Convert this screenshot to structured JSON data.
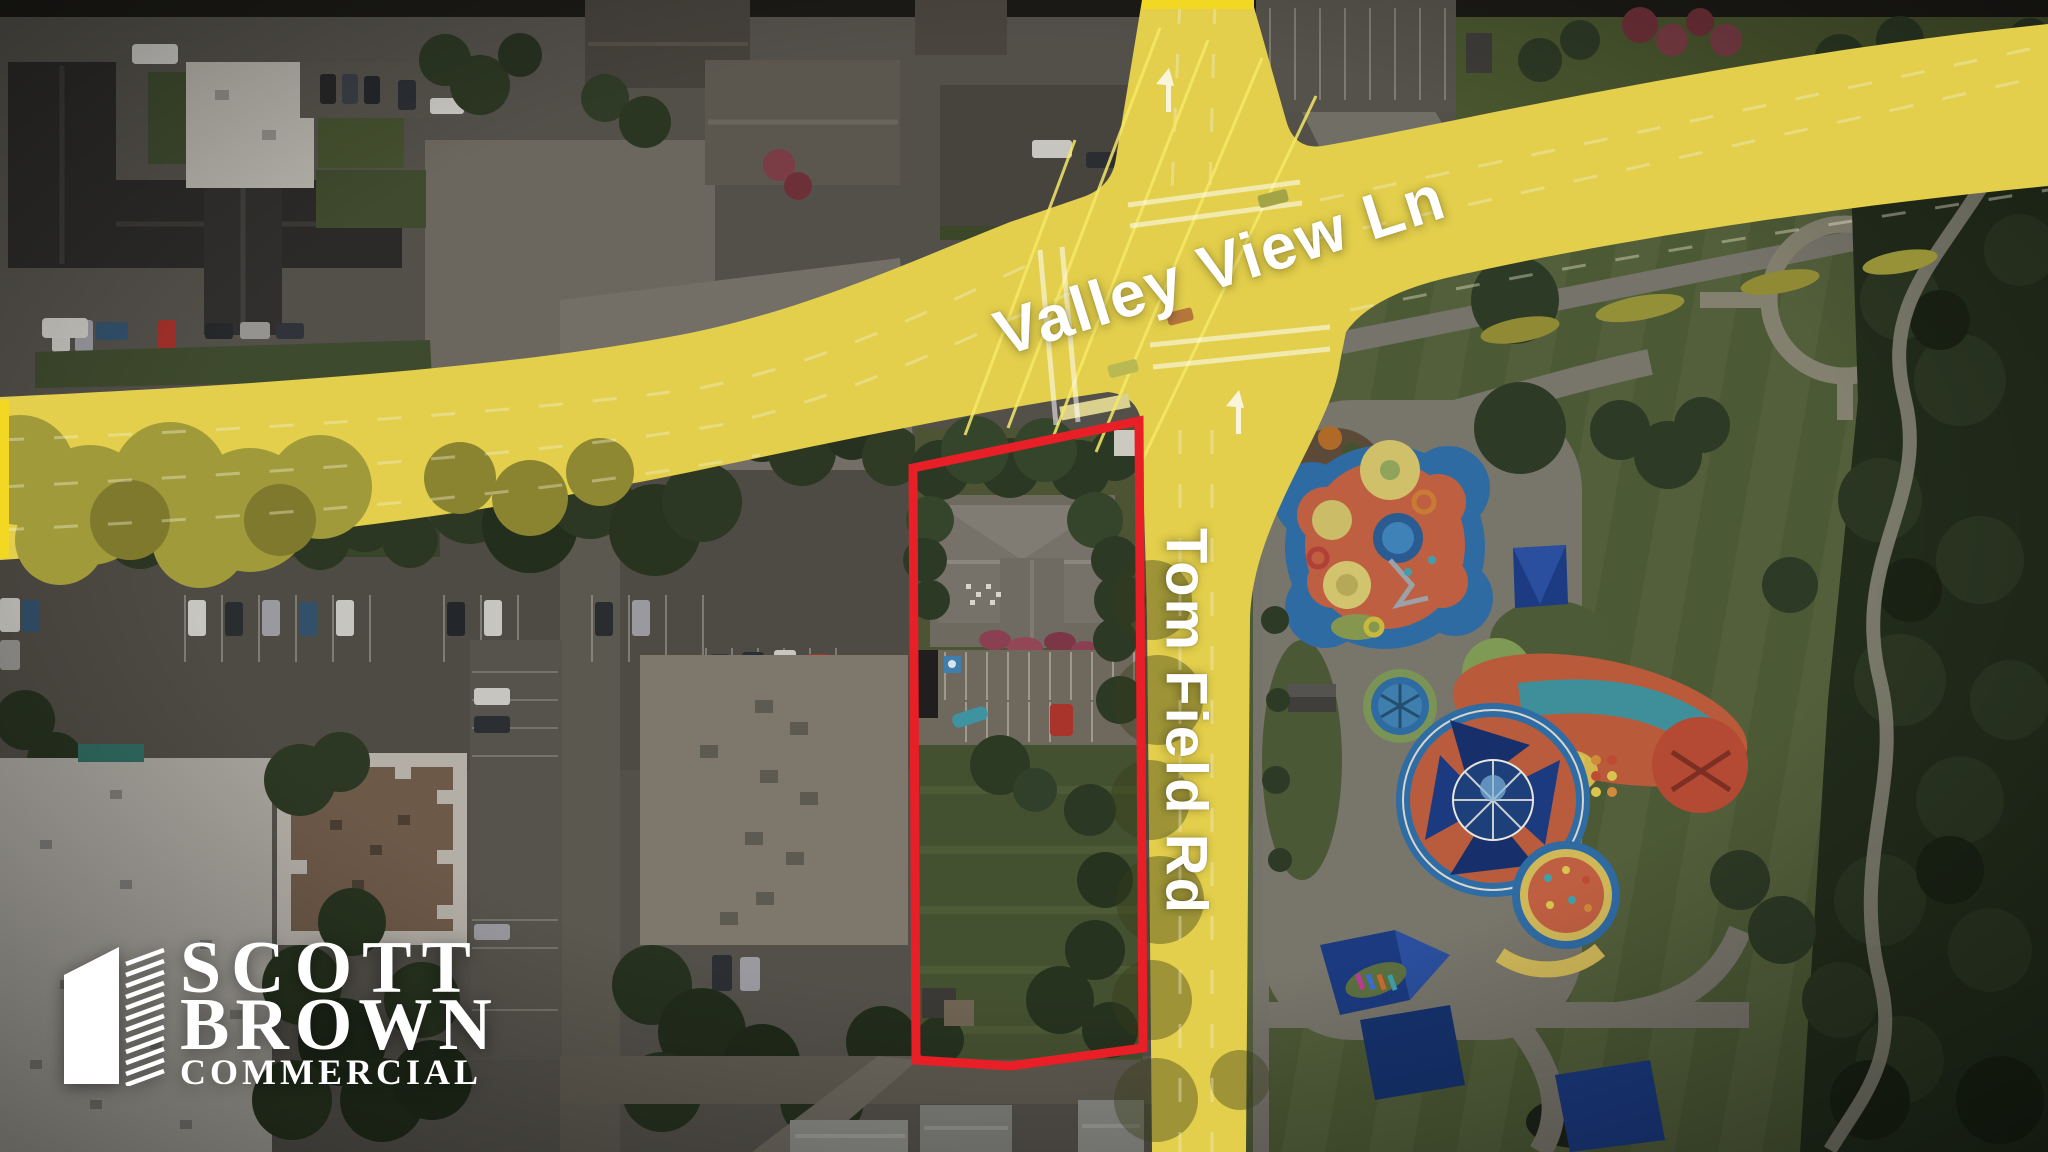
{
  "annotations": {
    "road_labels": [
      {
        "id": "valley-view-ln",
        "text": "Valley View Ln",
        "orientation": "diagonal-along-road"
      },
      {
        "id": "tom-field-rd",
        "text": "Tom Field Rd",
        "orientation": "vertical-along-road"
      }
    ],
    "property_outline": {
      "shape": "quadrilateral",
      "description": "red boundary around listed parcel"
    }
  },
  "logo": {
    "line1": "SCOTT",
    "line2": "BROWN",
    "line3": "COMMERCIAL"
  },
  "colors": {
    "road_highlight": "#f2d723",
    "road_highlight_fill": "#e3cf4b",
    "property_outline": "#e81f26",
    "label_text": "#ffffff",
    "logo_text": "#ffffff"
  }
}
